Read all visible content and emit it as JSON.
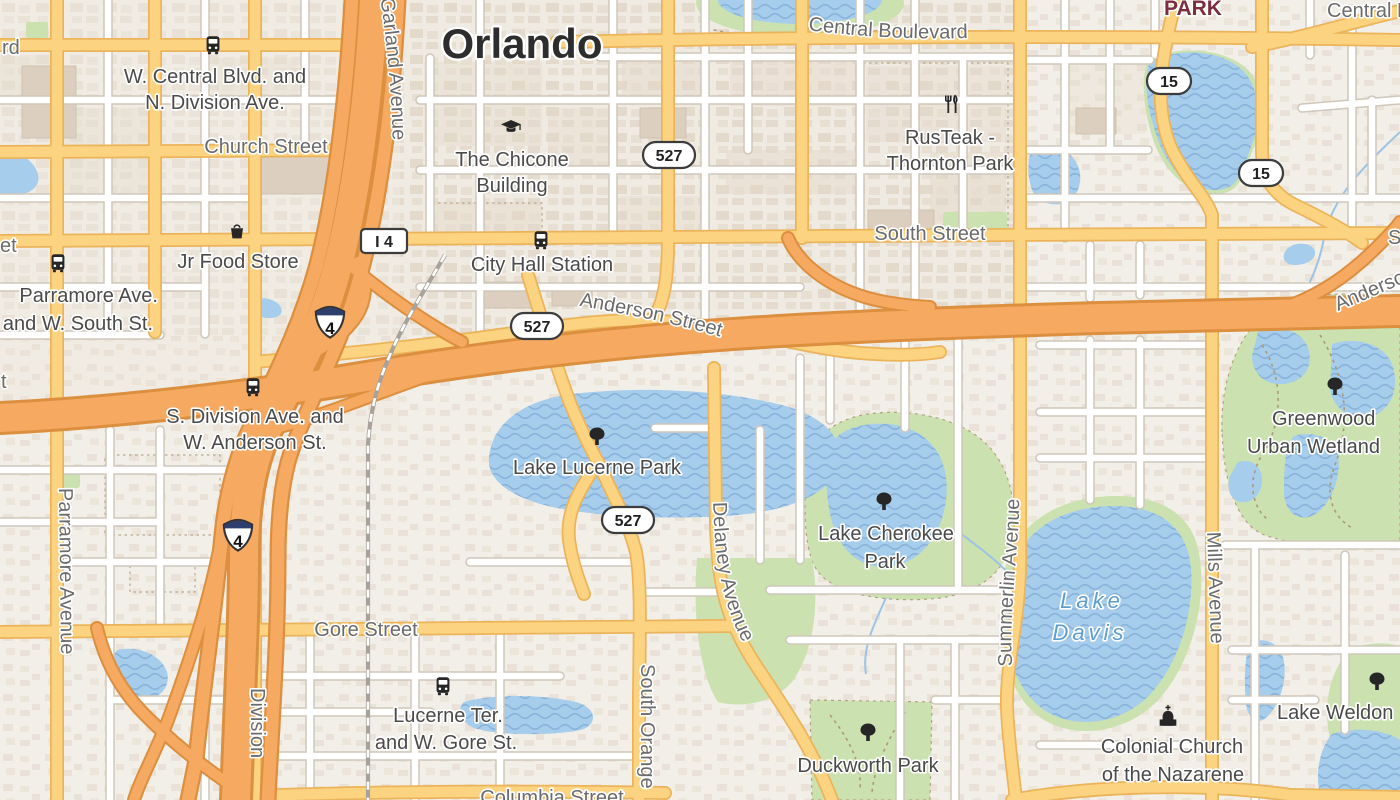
{
  "map": {
    "title": "Orlando",
    "streets": {
      "central_boulevard": "Central Boulevard",
      "church_street": "Church Street",
      "south_street": "South Street",
      "anderson_street": "Anderson Street",
      "gore_street": "Gore Street",
      "columbia_street": "Columbia Street",
      "garland_avenue": "Garland Avenue",
      "parramore_avenue": "Parramore Avenue",
      "division": "Division",
      "south_orange": "South Orange",
      "delaney_avenue": "Delaney Avenue",
      "summerlin_avenue": "Summerlin Avenue",
      "mills_avenue": "Mills Avenue",
      "south_street_right": "South Street",
      "anderson_street_right": "Anderson Street",
      "central_fragment": "Central Boulevard",
      "fragment_rd": "rd",
      "fragment_et": "et",
      "fragment_t": "t"
    },
    "places": {
      "park_fragment": "PARK",
      "chicone_line1": "The Chicone",
      "chicone_line2": "Building",
      "rusteak_line1": "RusTeak -",
      "rusteak_line2": "Thornton Park",
      "jr_food_store": "Jr Food Store",
      "lake_lucerne_park": "Lake Lucerne Park",
      "lake_cherokee_line1": "Lake Cherokee",
      "lake_cherokee_line2": "Park",
      "greenwood_line1": "Greenwood",
      "greenwood_line2": "Urban Wetland",
      "duckworth_park": "Duckworth Park",
      "colonial_line1": "Colonial Church",
      "colonial_line2": "of the Nazarene",
      "lake_weldon": "Lake Weldon"
    },
    "stations": {
      "w_central_line1": "W. Central Blvd. and",
      "w_central_line2": "N. Division Ave.",
      "city_hall": "City Hall Station",
      "parramore_line1": "Parramore Ave.",
      "parramore_line2": "and W. South St.",
      "s_division_line1": "S. Division Ave. and",
      "s_division_line2": "W. Anderson St.",
      "lucerne_line1": "Lucerne Ter.",
      "lucerne_line2": "and W. Gore St."
    },
    "water_labels": {
      "lake_davis_line1": "Lake",
      "lake_davis_line2": "Davis"
    },
    "shields": {
      "interstate": "4",
      "i4_label": "I 4",
      "route_527": "527",
      "route_15": "15"
    },
    "colors": {
      "land": "#f2efe9",
      "water": "#a6cdec",
      "park": "#cbe2b0",
      "road_secondary": "#fbd381",
      "road_highway": "#f5a961",
      "label_street": "#6b6b6b",
      "label_place": "#4a4a4a",
      "label_water": "#5c9dd2",
      "label_park": "#7c2d3e"
    }
  }
}
